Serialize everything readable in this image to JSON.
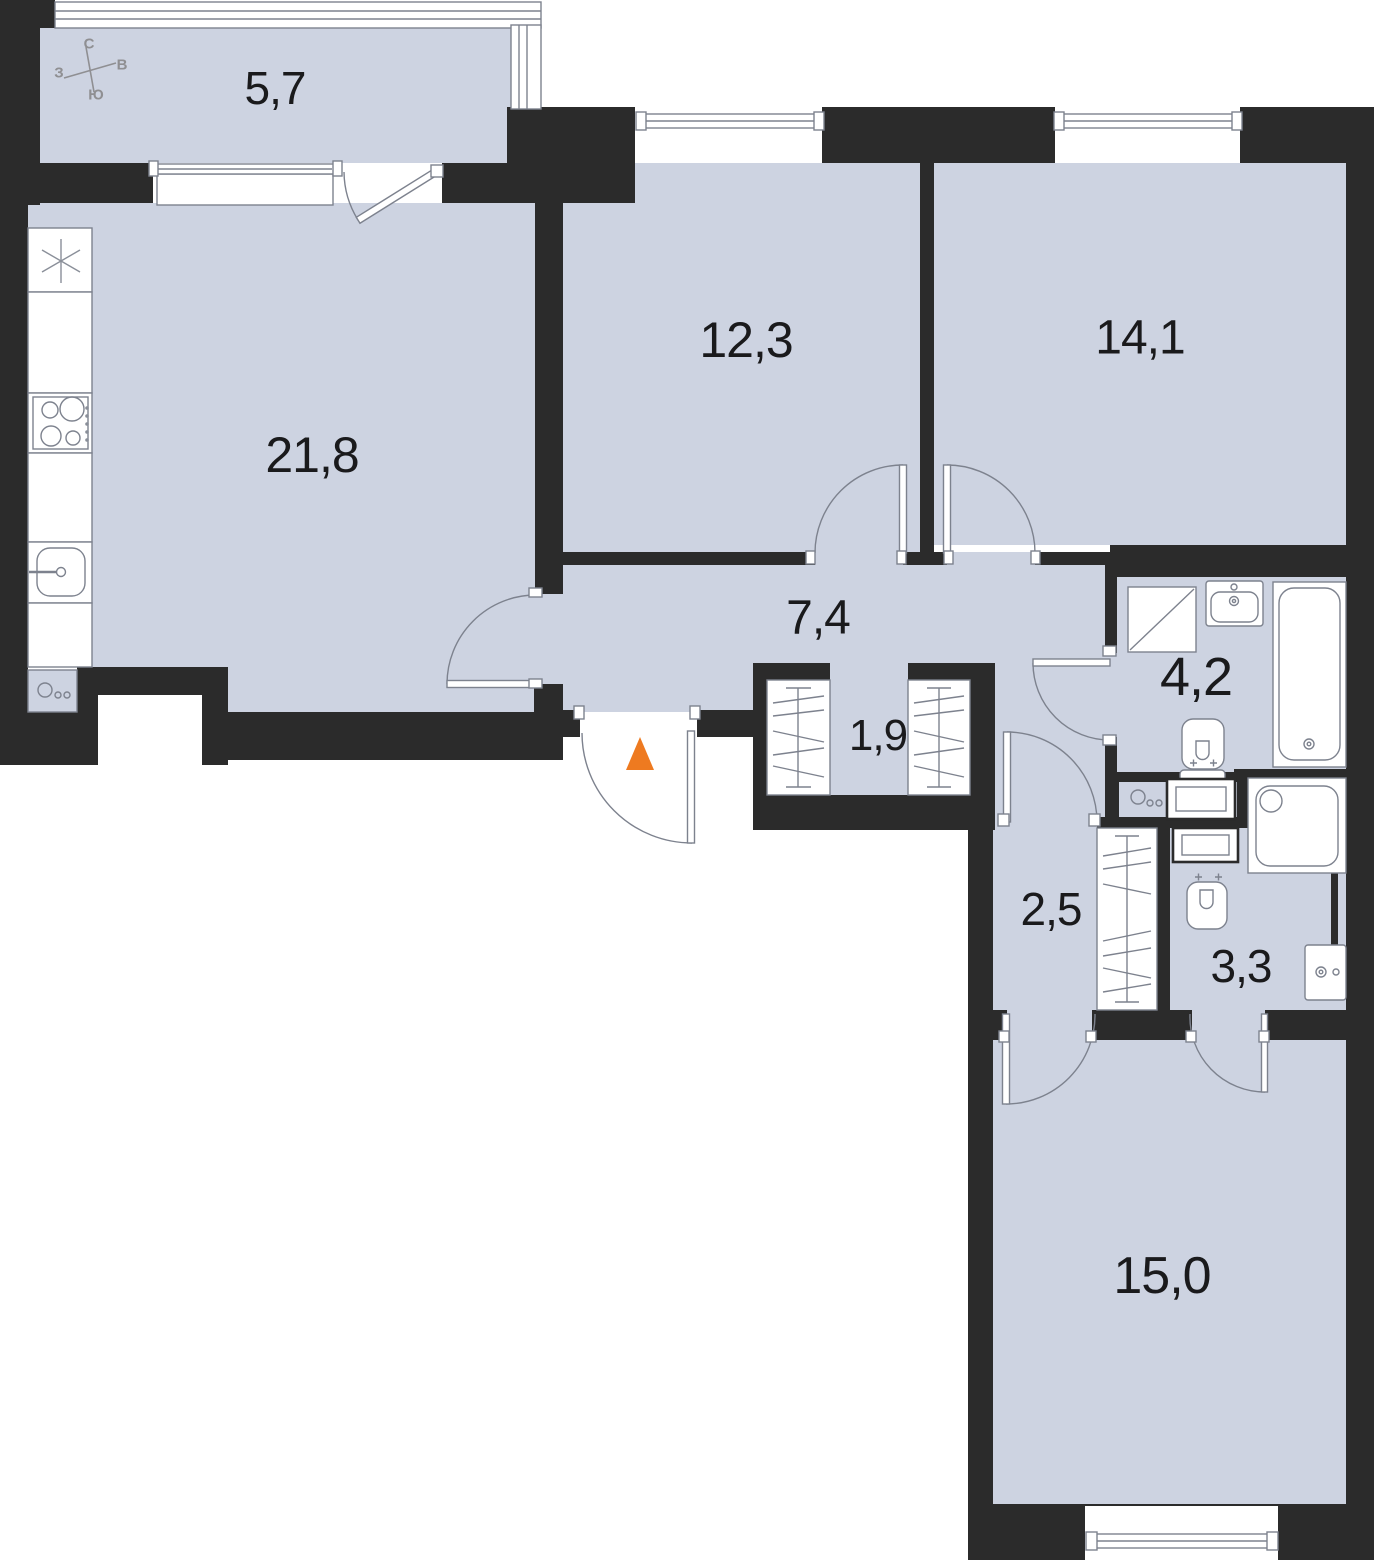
{
  "title": "Apartment floor plan",
  "compass": {
    "n": "С",
    "s": "Ю",
    "w": "З",
    "e": "В"
  },
  "rooms": {
    "balcony": {
      "label": "balcony",
      "area": "5,7"
    },
    "kitchen_living": {
      "label": "kitchen-living",
      "area": "21,8"
    },
    "bedroom_top": {
      "label": "bedroom",
      "area": "12,3"
    },
    "bedroom_right": {
      "label": "bedroom",
      "area": "14,1"
    },
    "hallway": {
      "label": "hallway",
      "area": "7,4"
    },
    "closet": {
      "label": "closet",
      "area": "1,9"
    },
    "bathroom": {
      "label": "bathroom",
      "area": "4,2"
    },
    "corridor": {
      "label": "corridor",
      "area": "2,5"
    },
    "shower_room": {
      "label": "shower room",
      "area": "3,3"
    },
    "bedroom_bottom": {
      "label": "bedroom",
      "area": "15,0"
    }
  },
  "colors": {
    "floor": "#cdd3e1",
    "wall": "#2b2b2b",
    "linework": "#7d828e",
    "entrance_marker": "#ee7a20"
  }
}
